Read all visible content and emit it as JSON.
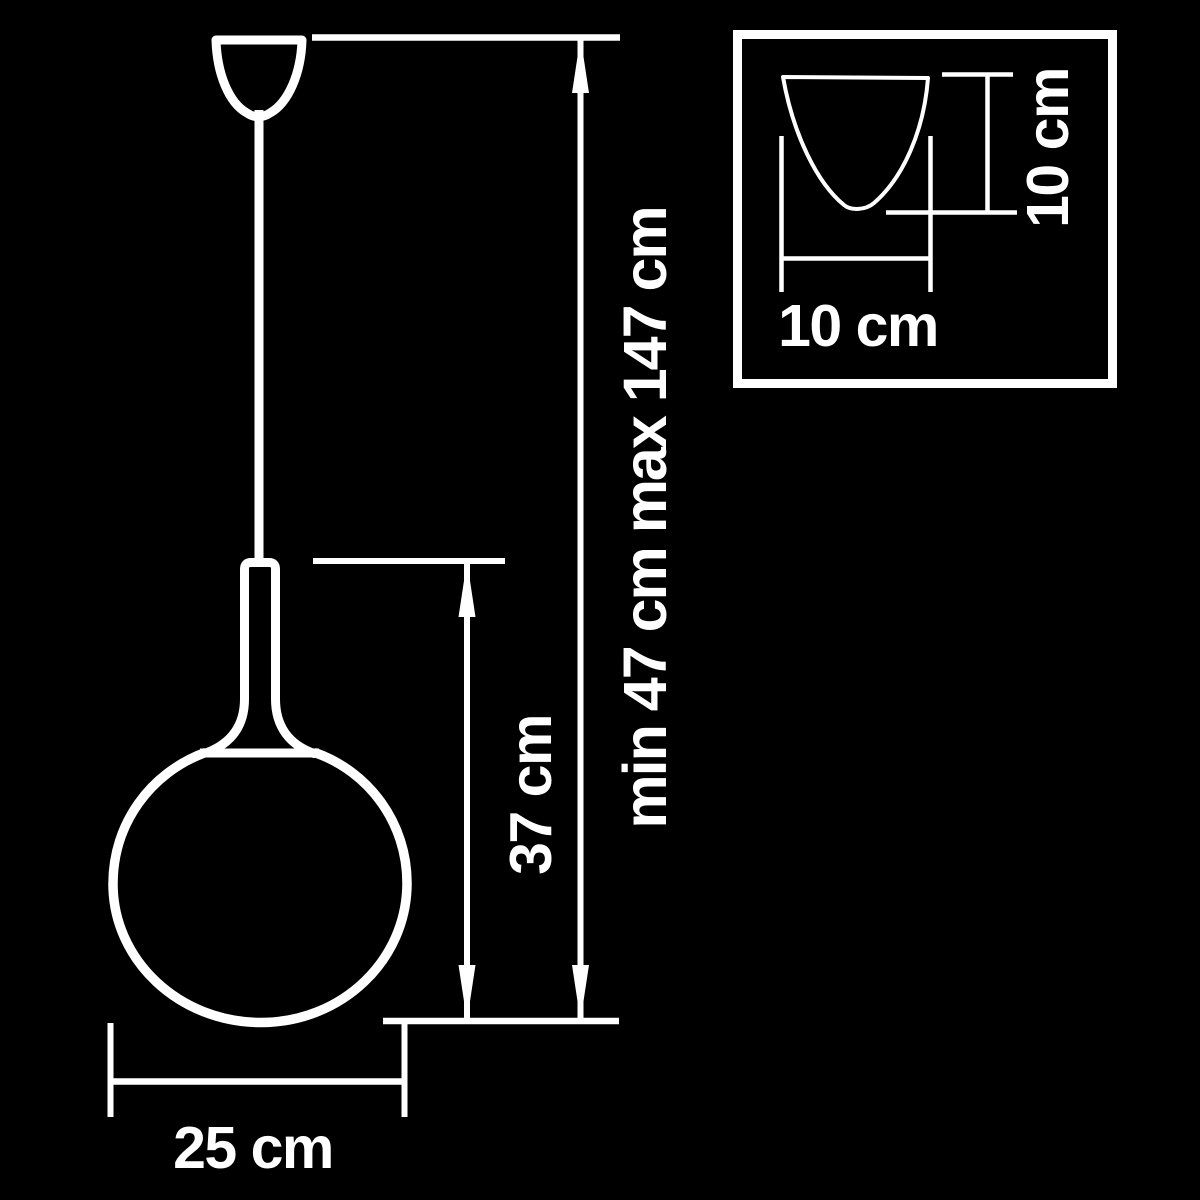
{
  "colors": {
    "background": "#000000",
    "ink": "#ffffff"
  },
  "drawing": {
    "kind": "pendant-lamp-dimension-diagram",
    "labels": {
      "suspension_range": "min 47 cm max 147 cm",
      "fixture_height": "37 cm",
      "shade_diameter": "25 cm",
      "canopy_width": "10 cm",
      "canopy_height": "10 cm"
    },
    "values": {
      "suspension_min_cm": 47,
      "suspension_max_cm": 147,
      "fixture_height_cm": 37,
      "shade_diameter_cm": 25,
      "canopy_width_cm": 10,
      "canopy_height_cm": 10
    }
  }
}
